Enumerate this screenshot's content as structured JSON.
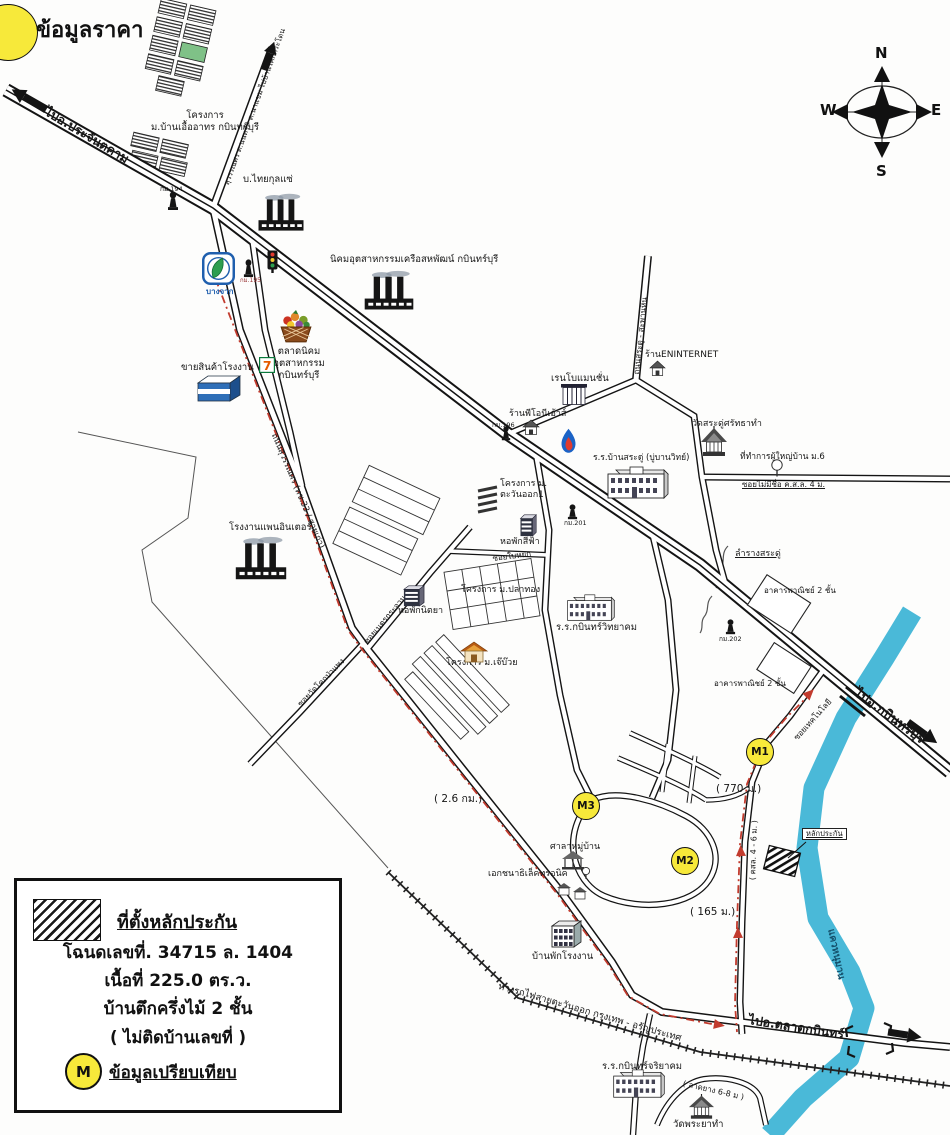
{
  "page": {
    "heading": "ข้อมูลราคา"
  },
  "compass": {
    "north": "N",
    "south": "S",
    "east": "E",
    "west": "W"
  },
  "legend": {
    "site_title": "ที่ตั้งหลักประกัน",
    "deed_line": "โฉนดเลขที่. 34715 ล. 1404",
    "area_line": "เนื้อที่ 225.0 ตร.ว.",
    "building_line": "บ้านตึกครึ่งไม้ 2 ชั้น",
    "note_line": "( ไม่ติดบ้านเลขที่ )",
    "marker_letter": "M",
    "marker_label": "ข้อมูลเปรียบเทียบ"
  },
  "colors": {
    "marker_fill": "#f7e93a",
    "route_red": "#c23b2e",
    "river_blue": "#4ab9d8",
    "road_casing": "#141414",
    "bangchak_blue": "#1f5fae"
  },
  "map": {
    "markers": [
      {
        "id": "M1",
        "x": 759,
        "y": 751
      },
      {
        "id": "M2",
        "x": 684,
        "y": 860
      },
      {
        "id": "M3",
        "x": 585,
        "y": 805
      }
    ],
    "labels": [
      {
        "name": "road-label-to-prachantakham",
        "text": "ไปอ.ประจันตคาม",
        "x": 50,
        "y": 104,
        "size": 12.5,
        "bold": true,
        "rot": 31
      },
      {
        "name": "proj-ban-uea-athorn-label",
        "text": "โครงการ\nม.บ้านเอื้ออาทร กบินทร์บุรี",
        "x": 140,
        "y": 110,
        "size": 9.5,
        "w": 130,
        "align": "center"
      },
      {
        "name": "road-label-suwannasorn-branch",
        "text": "สุวรรณศร ต.นนทรี - ต.นาแขม ไปบ้านโคกกระโดน",
        "x": 222,
        "y": 183,
        "size": 7.5,
        "rot": -70
      },
      {
        "name": "thai-kulsae-label",
        "text": "บ.ไทยกุลแซ่",
        "x": 243,
        "y": 174,
        "size": 9.5
      },
      {
        "name": "km194-label",
        "text": "กม.194",
        "x": 160,
        "y": 185,
        "size": 6.5
      },
      {
        "name": "nikhom-sahapat-label",
        "text": "นิคมอุตสาหกรรมเครือสหพัฒน์ กบินทร์บุรี",
        "x": 330,
        "y": 254,
        "size": 9.5
      },
      {
        "name": "bangchak-label",
        "text": "บางจาก",
        "x": 206,
        "y": 287,
        "size": 8,
        "bold": true,
        "color": "#1f5fae"
      },
      {
        "name": "km195-label",
        "text": "กม.195",
        "x": 240,
        "y": 277,
        "size": 6,
        "color": "#993333"
      },
      {
        "name": "talat-nikhom-label",
        "text": "ตลาดนิคมอุตสาหกรรม\nกบินทร์บุรี",
        "x": 253,
        "y": 346,
        "size": 9.5,
        "w": 92,
        "align": "center"
      },
      {
        "name": "khai-sinkha-label",
        "text": "ขายสินค้าโรงงาน",
        "x": 181,
        "y": 362,
        "size": 9.5
      },
      {
        "name": "rongngan-pan-inter-label",
        "text": "โรงงานแพนอินเตอร์",
        "x": 229,
        "y": 522,
        "size": 9.5
      },
      {
        "name": "road-label-suwannasorn-old",
        "text": "ถนนสุวรรณศร (ทช.33 / สายเก่า)",
        "x": 278,
        "y": 432,
        "size": 8.5,
        "rot": 67
      },
      {
        "name": "soi-wat-label",
        "text": "ซอยวัดโคกป่าแพง",
        "x": 296,
        "y": 702,
        "size": 8,
        "rot": -46
      },
      {
        "name": "soi-net-krachan-label",
        "text": "ซอยเนตรกระจาน",
        "x": 362,
        "y": 640,
        "size": 8,
        "rot": -50
      },
      {
        "name": "hophak-nittaya-label",
        "text": "หอพักนิตยา",
        "x": 398,
        "y": 606,
        "size": 9
      },
      {
        "name": "proj-tawan-ok-label",
        "text": "โครงการ ม.\nตะวันออก1",
        "x": 500,
        "y": 479,
        "size": 9
      },
      {
        "name": "km196-label",
        "text": "กม.196",
        "x": 492,
        "y": 421,
        "size": 6.5
      },
      {
        "name": "hophak-sifa-label",
        "text": "หอพักสีฟ้า",
        "x": 500,
        "y": 537,
        "size": 9
      },
      {
        "name": "soi-baiyok-label",
        "text": "ซอยใบหยก",
        "x": 492,
        "y": 554,
        "size": 8,
        "rot": -7
      },
      {
        "name": "proj-plathong-label",
        "text": "โครงการ ม.ปลาทอง",
        "x": 461,
        "y": 585,
        "size": 9
      },
      {
        "name": "proj-jebuay-label",
        "text": "โครงการ ม.เจ๊บ๊วย",
        "x": 446,
        "y": 658,
        "size": 9
      },
      {
        "name": "km201-label",
        "text": "กม.201",
        "x": 564,
        "y": 519,
        "size": 6.5
      },
      {
        "name": "rr-kabin-witthayakhom-label",
        "text": "ร.ร.กบินทร์วิทยาคม",
        "x": 556,
        "y": 622,
        "size": 9.5
      },
      {
        "name": "rr-ban-sadu-label",
        "text": "ร.ร.บ้านสระดู่ (บู่บานวิทย์)",
        "x": 593,
        "y": 453,
        "size": 8.5
      },
      {
        "name": "renbo-mansion-label",
        "text": "เรนโบแมนชั่น",
        "x": 551,
        "y": 373,
        "size": 9.5
      },
      {
        "name": "ran-pioni-label",
        "text": "ร้านพีโอนีเอ้าส์",
        "x": 509,
        "y": 409,
        "size": 9
      },
      {
        "name": "ran-eninternet-label",
        "text": "ร้านENINTERNET",
        "x": 645,
        "y": 350,
        "size": 9
      },
      {
        "name": "road-label-sadu-saphanhin",
        "text": "ถนนสระดู่ - สะพานหิน",
        "x": 632,
        "y": 374,
        "size": 8,
        "rot": -84
      },
      {
        "name": "wat-sadu-label",
        "text": "วัดสระดู่ศรัทธาทำ",
        "x": 692,
        "y": 419,
        "size": 9
      },
      {
        "name": "phuyai-ban-label",
        "text": "ที่ทำการผู้ใหญ่บ้าน ม.6",
        "x": 740,
        "y": 452,
        "size": 8.5
      },
      {
        "name": "soi-maimichue-label",
        "text": "ซอยไม่มีชื่อ ค.ส.ล. 4 ม.",
        "x": 742,
        "y": 480,
        "size": 8,
        "underline": true
      },
      {
        "name": "lamrang-sadu-label",
        "text": "ลำรางสระดู่",
        "x": 735,
        "y": 549,
        "size": 9,
        "underline": true
      },
      {
        "name": "akhan-phanich-1-label",
        "text": "อาคารพาณิชย์ 2 ชั้น",
        "x": 764,
        "y": 586,
        "size": 8
      },
      {
        "name": "km202-label",
        "text": "กม.202",
        "x": 719,
        "y": 635,
        "size": 6.5
      },
      {
        "name": "akhan-phanich-2-label",
        "text": "อาคารพาณิชย์ 2 ชั้น",
        "x": 714,
        "y": 679,
        "size": 8
      },
      {
        "name": "road-label-soi-technology",
        "text": "ซอยเทคโนโลยี",
        "x": 792,
        "y": 736,
        "size": 8,
        "rot": -48
      },
      {
        "name": "road-label-to-kabinburi",
        "text": "ไปอ.กบินทร์บุรี",
        "x": 860,
        "y": 686,
        "size": 13,
        "bold": true,
        "rot": 36
      },
      {
        "name": "dist-770m-label",
        "text": "( 770 ม.)",
        "x": 716,
        "y": 783,
        "size": 10.5
      },
      {
        "name": "dist-26km-label",
        "text": "( 2.6 กม.)",
        "x": 434,
        "y": 793,
        "size": 10.5
      },
      {
        "name": "dist-165m-label",
        "text": "( 165 ม.)",
        "x": 690,
        "y": 906,
        "size": 10.5
      },
      {
        "name": "sala-muban-label",
        "text": "ศาลาหมู่บ้าน",
        "x": 550,
        "y": 842,
        "size": 9
      },
      {
        "name": "ekachana-label",
        "text": "เอกชนาธิเล็คทรอนิค",
        "x": 488,
        "y": 869,
        "size": 9
      },
      {
        "name": "kso-l-4-6-label",
        "text": "( คสล. 4 - 6 ม. )",
        "x": 748,
        "y": 880,
        "size": 8,
        "rot": -88
      },
      {
        "name": "kwae-hanuman-label",
        "text": "แควหนุมาน",
        "x": 836,
        "y": 928,
        "size": 10,
        "rot": 78,
        "color": "#14506b",
        "bold": true
      },
      {
        "name": "banphak-rongngan-label",
        "text": "บ้านพักโรงงาน",
        "x": 532,
        "y": 951,
        "size": 9.5
      },
      {
        "name": "railway-label",
        "text": "ทางรถไฟสายตะวันออก กรุงเทพ - อรัญประเทศ",
        "x": 500,
        "y": 981,
        "size": 9.5,
        "rot": 16
      },
      {
        "name": "road-label-to-talat-kabin",
        "text": "ไปอ.ตลาดกบินทร์",
        "x": 750,
        "y": 1012,
        "size": 12.5,
        "bold": true,
        "rot": 9
      },
      {
        "name": "rr-kabin-jariyakhom-label",
        "text": "ร.ร.กบินทร์จริยาคม",
        "x": 602,
        "y": 1061,
        "size": 9.5
      },
      {
        "name": "ladyang-label",
        "text": "( ลาดยาง 6-8 ม )",
        "x": 684,
        "y": 1079,
        "size": 8,
        "rot": 13
      },
      {
        "name": "wat-phraya-tham-label",
        "text": "วัดพระยาทำ",
        "x": 673,
        "y": 1119,
        "size": 9.5
      },
      {
        "name": "lak-prakan-tag",
        "text": "หลักประกัน",
        "x": 802,
        "y": 828,
        "size": 7.5,
        "underline": true,
        "boxed": true
      }
    ],
    "icons": [
      {
        "name": "factory-icon-thaikulsae",
        "type": "factory",
        "x": 256,
        "y": 193,
        "w": 50,
        "h": 40
      },
      {
        "name": "factory-icon-sahapat",
        "type": "factory",
        "x": 362,
        "y": 270,
        "w": 54,
        "h": 42
      },
      {
        "name": "factory-icon-paninter",
        "type": "factory",
        "x": 233,
        "y": 536,
        "w": 56,
        "h": 46
      },
      {
        "name": "bangchak-logo-icon",
        "type": "bangchak",
        "x": 202,
        "y": 252,
        "w": 33,
        "h": 33
      },
      {
        "name": "traffic-light-icon",
        "type": "traffic",
        "x": 267,
        "y": 250,
        "w": 11,
        "h": 23
      },
      {
        "name": "km-post-icon-194",
        "type": "kmpost",
        "x": 167,
        "y": 191,
        "w": 12,
        "h": 20
      },
      {
        "name": "km-post-icon-195",
        "type": "kmpost",
        "x": 243,
        "y": 259,
        "w": 11,
        "h": 19
      },
      {
        "name": "km-post-icon-196",
        "type": "kmpost",
        "x": 501,
        "y": 426,
        "w": 10,
        "h": 15
      },
      {
        "name": "km-post-icon-201",
        "type": "kmpost",
        "x": 567,
        "y": 504,
        "w": 11,
        "h": 16
      },
      {
        "name": "km-post-icon-202",
        "type": "kmpost",
        "x": 725,
        "y": 619,
        "w": 11,
        "h": 16
      },
      {
        "name": "market-basket-icon",
        "type": "basket",
        "x": 278,
        "y": 310,
        "w": 36,
        "h": 34
      },
      {
        "name": "seven-eleven-icon",
        "type": "seven",
        "x": 259,
        "y": 357,
        "w": 16,
        "h": 16
      },
      {
        "name": "factory-outlet-shop-icon",
        "type": "shop3d",
        "x": 196,
        "y": 374,
        "w": 46,
        "h": 30
      },
      {
        "name": "mansion-icon-renbo",
        "type": "mansion",
        "x": 560,
        "y": 382,
        "w": 28,
        "h": 23
      },
      {
        "name": "house-icon-pioni",
        "type": "house",
        "x": 522,
        "y": 419,
        "w": 18,
        "h": 16
      },
      {
        "name": "house-icon-eninternet",
        "type": "house",
        "x": 649,
        "y": 360,
        "w": 17,
        "h": 16
      },
      {
        "name": "ptt-flame-icon",
        "type": "pttflame",
        "x": 558,
        "y": 428,
        "w": 21,
        "h": 27
      },
      {
        "name": "school-icon-ban-sadu",
        "type": "school",
        "x": 606,
        "y": 466,
        "w": 64,
        "h": 34
      },
      {
        "name": "temple-icon-wat-sadu",
        "type": "temple",
        "x": 700,
        "y": 426,
        "w": 28,
        "h": 34
      },
      {
        "name": "tree-icon-phuyai-ban",
        "type": "tree",
        "x": 770,
        "y": 459,
        "w": 14,
        "h": 18
      },
      {
        "name": "dorm-icon-sifa",
        "type": "dorm",
        "x": 519,
        "y": 513,
        "w": 18,
        "h": 24
      },
      {
        "name": "dorm-icon-nittaya",
        "type": "dorm",
        "x": 402,
        "y": 584,
        "w": 23,
        "h": 23
      },
      {
        "name": "school-icon-witthayakhom",
        "type": "school",
        "x": 566,
        "y": 594,
        "w": 50,
        "h": 28
      },
      {
        "name": "orange-house-icon-jebuay",
        "type": "orangehouse",
        "x": 460,
        "y": 641,
        "w": 28,
        "h": 22
      },
      {
        "name": "pavilion-icon-sala-muban",
        "type": "pavilion",
        "x": 560,
        "y": 850,
        "w": 30,
        "h": 30
      },
      {
        "name": "houses-icon-ekachana",
        "type": "houses",
        "x": 556,
        "y": 878,
        "w": 32,
        "h": 27
      },
      {
        "name": "worker-housing-icon",
        "type": "workerhouse",
        "x": 548,
        "y": 918,
        "w": 36,
        "h": 33
      },
      {
        "name": "school-icon-jariyakhom",
        "type": "school",
        "x": 612,
        "y": 1069,
        "w": 54,
        "h": 30
      },
      {
        "name": "temple-icon-wat-phraya",
        "type": "temple",
        "x": 688,
        "y": 1094,
        "w": 27,
        "h": 28
      }
    ]
  }
}
